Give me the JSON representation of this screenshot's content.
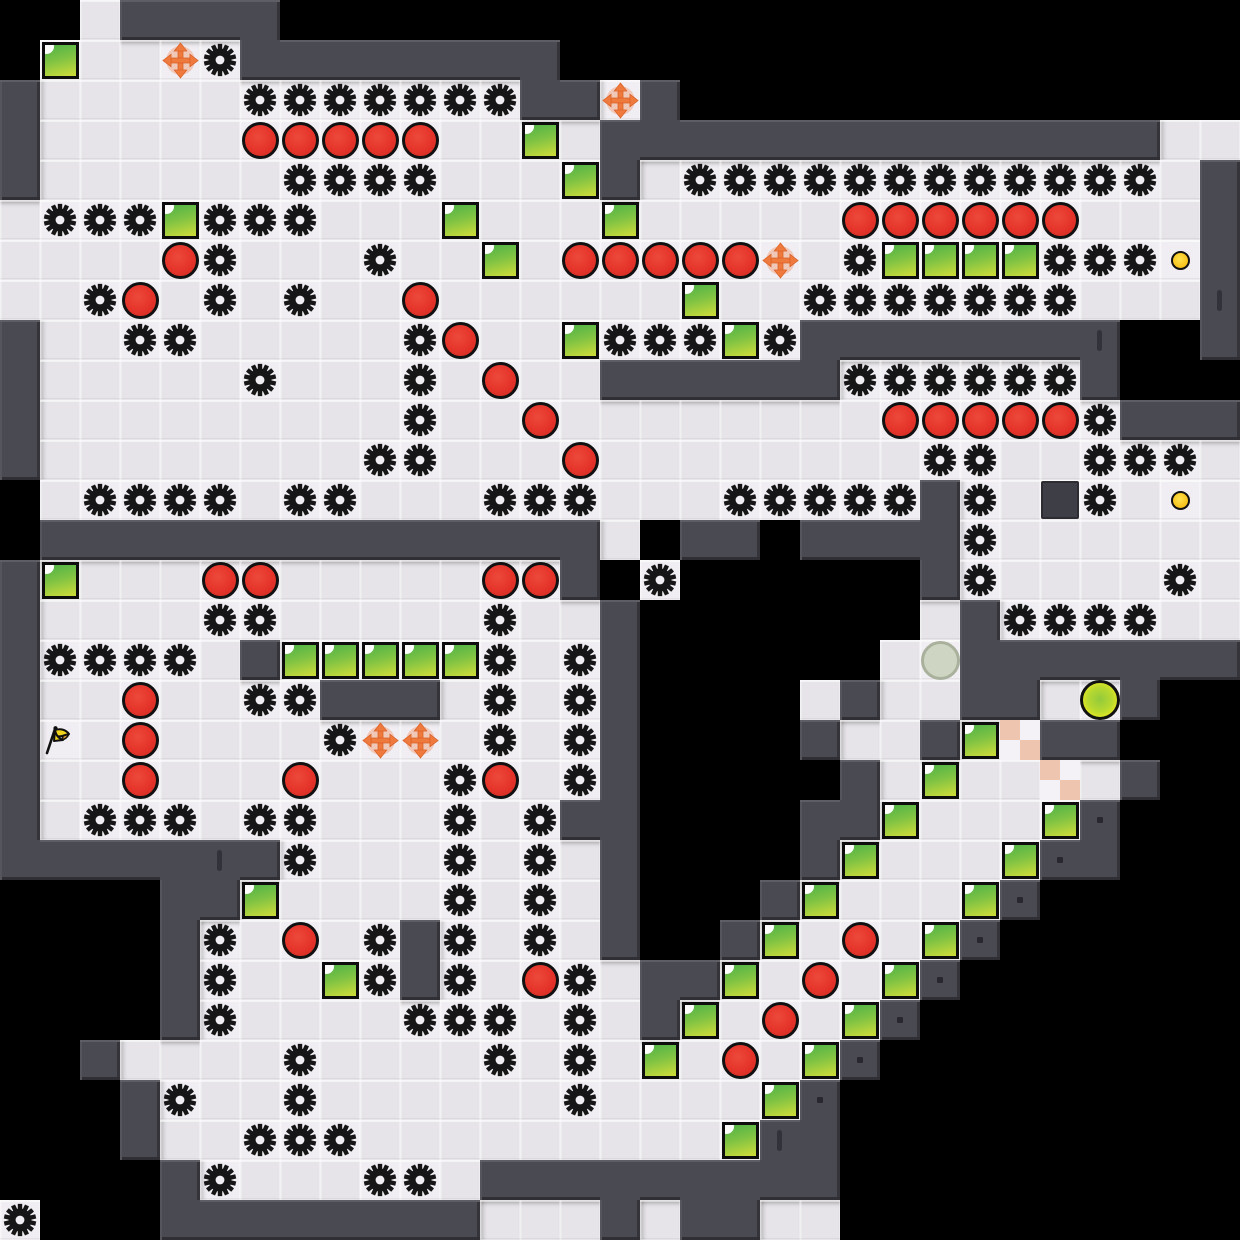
{
  "level": {
    "tile_size": 40,
    "cols": 31,
    "rows": 31,
    "grid": [
      "  .####                        ",
      " G..og########                 ",
      "#.....ggggggg##o#              ",
      "#.....rrrrr..G.##############..",
      "#......gggg...G#.gggggggggggg.#",
      ".gggGggg...G...G.....rrrrrr...#",
      "....rg...g..G.rrrrro.gGGGGgggy#",
      "..gr.g.g..r......G..ggggggg...#",
      "#..gg.....gr..GgggGg########  #",
      "#.....g...g.r..######gggggg#   ",
      "#.........g..r........rrrrrg###",
      "#........gg...r........gg..ggg.",
      " .gggg.gg...ggg...ggggg#g.Dg.y.",
      " ##############. ## ####g......",
      "#G...rr.....rr# g      #g....g.",
      "#....gg.....g..#       .#gggg..",
      "#gggg.#GGGGGg.g#      .W#######",
      "#..r..gg###.g.g#    .#..##.Y#  ",
      "#F.r....goo.g.g#    #..#GP##   ",
      "#..r...r...gr.g#     #.G..P.#  ",
      "#.ggg.gg...g.g##    ##G...G#   ",
      "#######g...g.g.#    #G...G##   ",
      "    ##G....g.g.#   #G...G#     ",
      "    #g.r.g#g.g.#  #G.r.G#      ",
      "    #g..Gg#g.rg.##G.r.G#       ",
      "    #g....ggg.g.#G.r.G#        ",
      "  #....g....g.g.G.r.G#         ",
      "   #g..g......g....G#          ",
      "   #..ggg.........G##          ",
      "    #g...gg.#########          ",
      "g   ########...#.##..          "
    ],
    "legend": {
      ".": "floor",
      "#": "wall",
      "g": "gear-saw",
      "r": "red-ball",
      "G": "green-block",
      "o": "move-arrows",
      "y": "coin-dot",
      "Y": "player-ball",
      "W": "ghost-ball",
      "F": "flag",
      "P": "checker-tile",
      "D": "stone-block"
    },
    "wall_ticks": [
      [
        30,
        7
      ],
      [
        27,
        8
      ],
      [
        5,
        21
      ],
      [
        19,
        28
      ]
    ],
    "wall_dots": [
      [
        27,
        20
      ],
      [
        26,
        21
      ],
      [
        25,
        22
      ],
      [
        24,
        23
      ],
      [
        23,
        24
      ],
      [
        22,
        25
      ],
      [
        21,
        26
      ],
      [
        20,
        27
      ]
    ],
    "palette": {
      "void": "#000000",
      "floor": "#e6e4e8",
      "floor_entity": "#f0eef2",
      "wall": "#4a4a52",
      "wall_highlight": "#5e5e66",
      "wall_shadow": "#2f2f35",
      "gear": "#161616",
      "red_ball": "#e5332a",
      "green_block_top": "#53b447",
      "green_block_bottom": "#c9da3a",
      "arrow_orange": "#ee7a3e",
      "coin_yellow": "#f6c21b",
      "player_green": "#b9d92f",
      "player_yellow": "#e9e922",
      "ghost_gray": "#ced5c2",
      "flag_yellow": "#f2d41c",
      "flag_tail_orange": "#f0a026",
      "checker_pink": "#eec6b0",
      "stone_block": "#3e3e46"
    }
  }
}
